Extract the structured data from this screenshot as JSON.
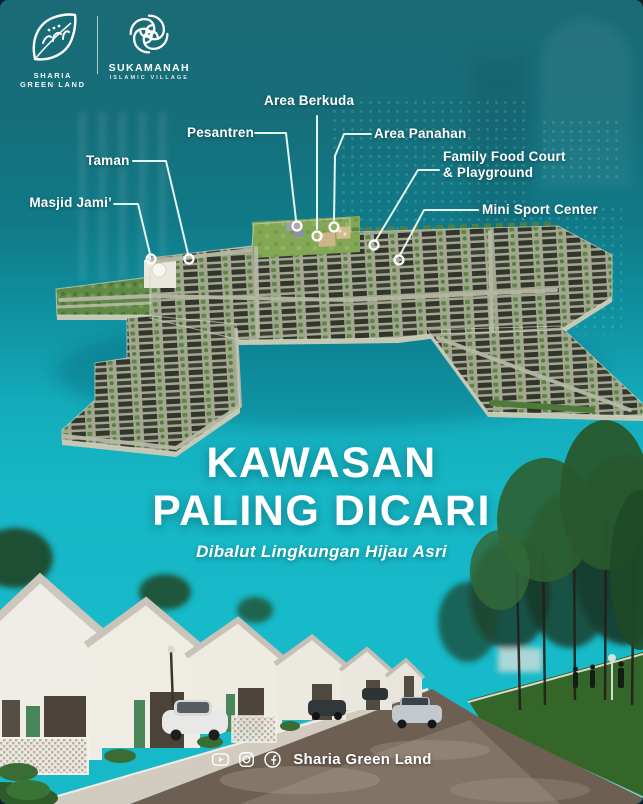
{
  "brand": {
    "sharia": {
      "line1": "SHARIA",
      "line2": "GREEN LAND"
    },
    "sukamanah": {
      "name": "SUKAMANAH",
      "tagline": "ISLAMIC VILLAGE"
    }
  },
  "icons": {
    "brand_left": "leaf-arabic-calligraphy",
    "brand_right": "geometric-knot",
    "social": [
      "youtube",
      "instagram",
      "facebook"
    ]
  },
  "map_callouts": {
    "masjid": "Masjid Jami’",
    "taman": "Taman",
    "pesantren": "Pesantren",
    "berkuda": "Area Berkuda",
    "panahan": "Area Panahan",
    "foodcourt_line1": "Family Food Court",
    "foodcourt_line2": "& Playground",
    "sport": "Mini Sport Center"
  },
  "headline": {
    "line1": "KAWASAN",
    "line2": "PALING DICARI",
    "subtitle": "Dibalut Lingkungan Hijau Asri"
  },
  "footer": {
    "handle": "Sharia Green Land"
  },
  "colors": {
    "teal_dark": "#17656f",
    "teal_bright": "#16b5c5",
    "text_white": "#ffffff",
    "map_green": "#82a755",
    "roof_dark": "#31352b"
  }
}
